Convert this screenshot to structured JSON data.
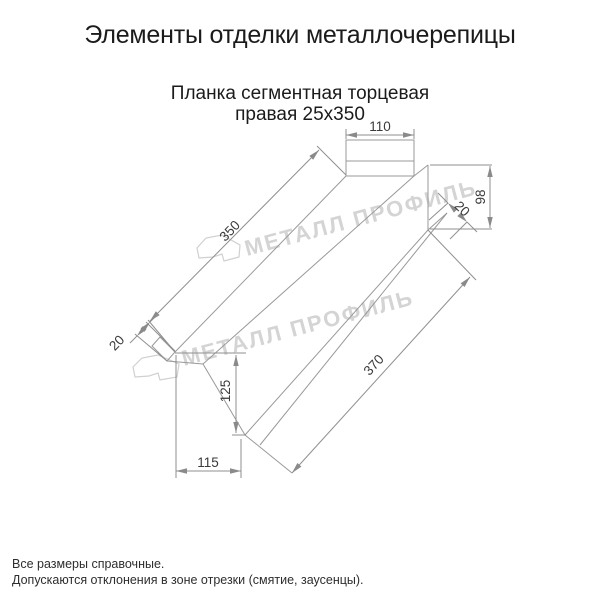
{
  "page": {
    "title": "Элементы отделки металлочерепицы",
    "subtitle_line1": "Планка сегментная торцевая",
    "subtitle_line2": "правая 25х350"
  },
  "drawing": {
    "dims": {
      "top_flange_width": "110",
      "face_height": "98",
      "right_lip": "20",
      "top_edge_length": "350",
      "left_lip": "20",
      "bottom_edge_length": "370",
      "left_face_height": "125",
      "bottom_width": "115"
    }
  },
  "watermark": {
    "brand": "МЕТАЛЛ ПРОФИЛЬ"
  },
  "footer": {
    "note1": "Все размеры справочные.",
    "note2": "Допускаются отклонения в зоне отрезки (смятие, заусенцы)."
  },
  "colors": {
    "line": "#999999",
    "dim_text": "#3a3a3a",
    "watermark": "#d4d4d4",
    "text": "#1b1b1b"
  }
}
